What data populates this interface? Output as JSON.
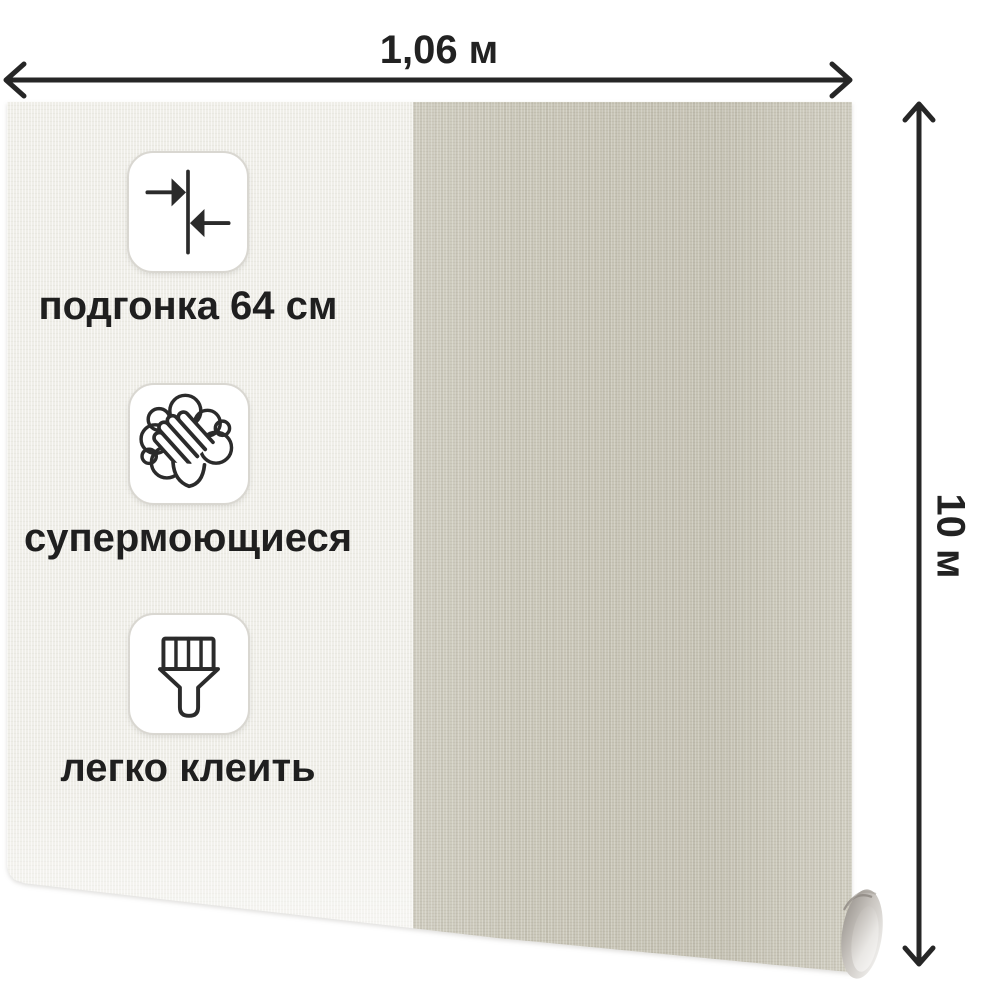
{
  "product": {
    "kind": "wallpaper-roll-dimensions-image"
  },
  "dimensions": {
    "width_label": "1,06 м",
    "length_label": "10 м"
  },
  "features": [
    {
      "icon": "pattern-match-icon",
      "label": "подгонка 64 см"
    },
    {
      "icon": "washing-hands-icon",
      "label": "супермоющиеся"
    },
    {
      "icon": "paint-brush-icon",
      "label": "легко клеить"
    }
  ],
  "colors": {
    "background": "#ffffff",
    "annotation_ink": "#262626",
    "wallpaper_light_panel": "#efeee8",
    "wallpaper_beige_panel": "#cbc8ba",
    "feature_card_background": "#ffffff",
    "feature_card_border": "#d9d7d1",
    "roll_curl_shade": "#9d9892"
  }
}
